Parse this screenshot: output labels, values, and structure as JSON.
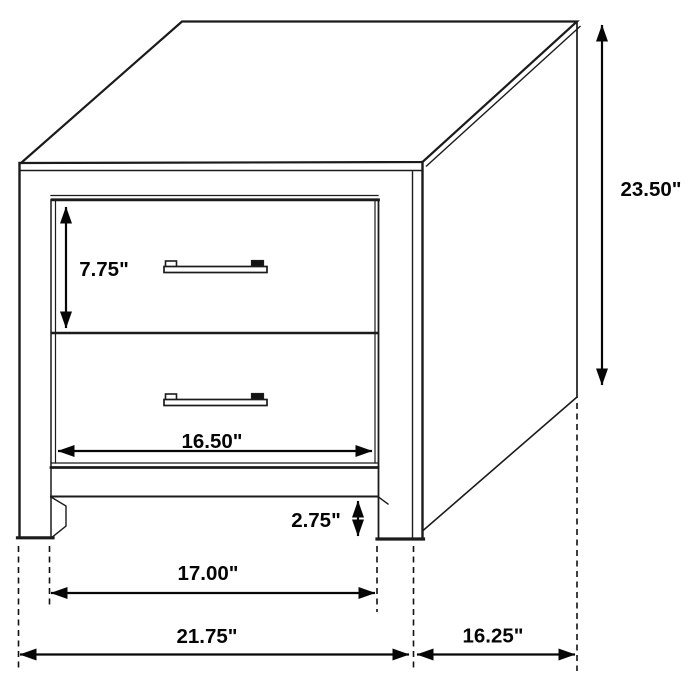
{
  "diagram": {
    "title": "nightstand-dimension-diagram",
    "product": "two-drawer nightstand line drawing",
    "colors": {
      "background": "#ffffff",
      "line": "#1b1b1b",
      "dimension": "#050505",
      "receding_edge": "#8d8d8d"
    },
    "labels": {
      "overall_height": "23.50\"",
      "drawer_height": "7.75\"",
      "drawer_inner_width": "16.50\"",
      "base_clearance": "2.75\"",
      "leg_inner_span": "17.00\"",
      "overall_width": "21.75\"",
      "overall_depth": "16.25\""
    }
  }
}
